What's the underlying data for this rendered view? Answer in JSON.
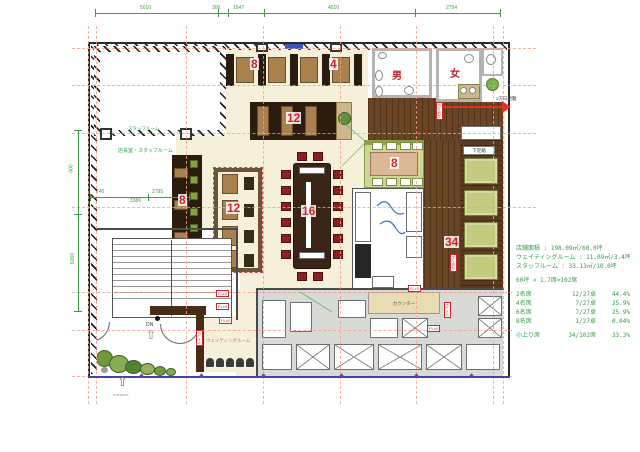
{
  "labels": {
    "mens_wc": "男",
    "womens_wc": "女",
    "staff_room_small": "スタッフルーム",
    "staff_room": "店長室・スタッフルーム",
    "waiting_room": "ウェイティングルーム",
    "shoe_box": "下足箱",
    "counter": "カウンター",
    "evacuation": "2方向避難",
    "entrance": "entrance",
    "down": "DN"
  },
  "seat_counts": {
    "counter_left": "8",
    "counter_right": "4",
    "booth_row": "12",
    "side_booth": "8",
    "center_block": "12",
    "main_table": "16",
    "teppan_table": "8",
    "koagari": "34"
  },
  "floor_levels": {
    "plus500": "FL+500",
    "zero": "FL±0"
  },
  "dimensions": {
    "top": [
      "5010",
      "300",
      "1547",
      "4510",
      "2754"
    ],
    "left": [
      "600",
      "6000"
    ],
    "inner": [
      "740",
      "2795",
      "3386"
    ]
  },
  "stats": {
    "area_lines": [
      "店舗面積 : 198.09㎡/60.0坪",
      "ウェイティングルーム : 11.09㎡/3.4坪",
      "スタッフルーム : 33.13㎡/10.0坪"
    ],
    "capacity_line": "60坪 × 1.7席=102席",
    "seat_rows": [
      {
        "label": "2名席",
        "ratio": "12/27卓",
        "pct": "44.4%"
      },
      {
        "label": "4名席",
        "ratio": "7/27卓",
        "pct": "25.9%"
      },
      {
        "label": "6名席",
        "ratio": "7/27卓",
        "pct": "25.9%"
      },
      {
        "label": "8名席",
        "ratio": "1/27卓",
        "pct": "0.04%"
      }
    ],
    "total_row": {
      "label": "小上り席",
      "ratio": "34/102席",
      "pct": "33.3%"
    }
  },
  "colors": {
    "dim_green": "#3f9b3f",
    "text_green": "#2f9e47",
    "grid_salmon": "#f2a088",
    "seat_red": "#d2232a",
    "wood_dark": "#2b1c10",
    "wood_mid": "#6b4423",
    "tatami_green": "#c3cc7c",
    "kitchen_grey": "#d9d9d5",
    "floor_cream": "#f6efda",
    "blue_line": "#4343a8"
  }
}
